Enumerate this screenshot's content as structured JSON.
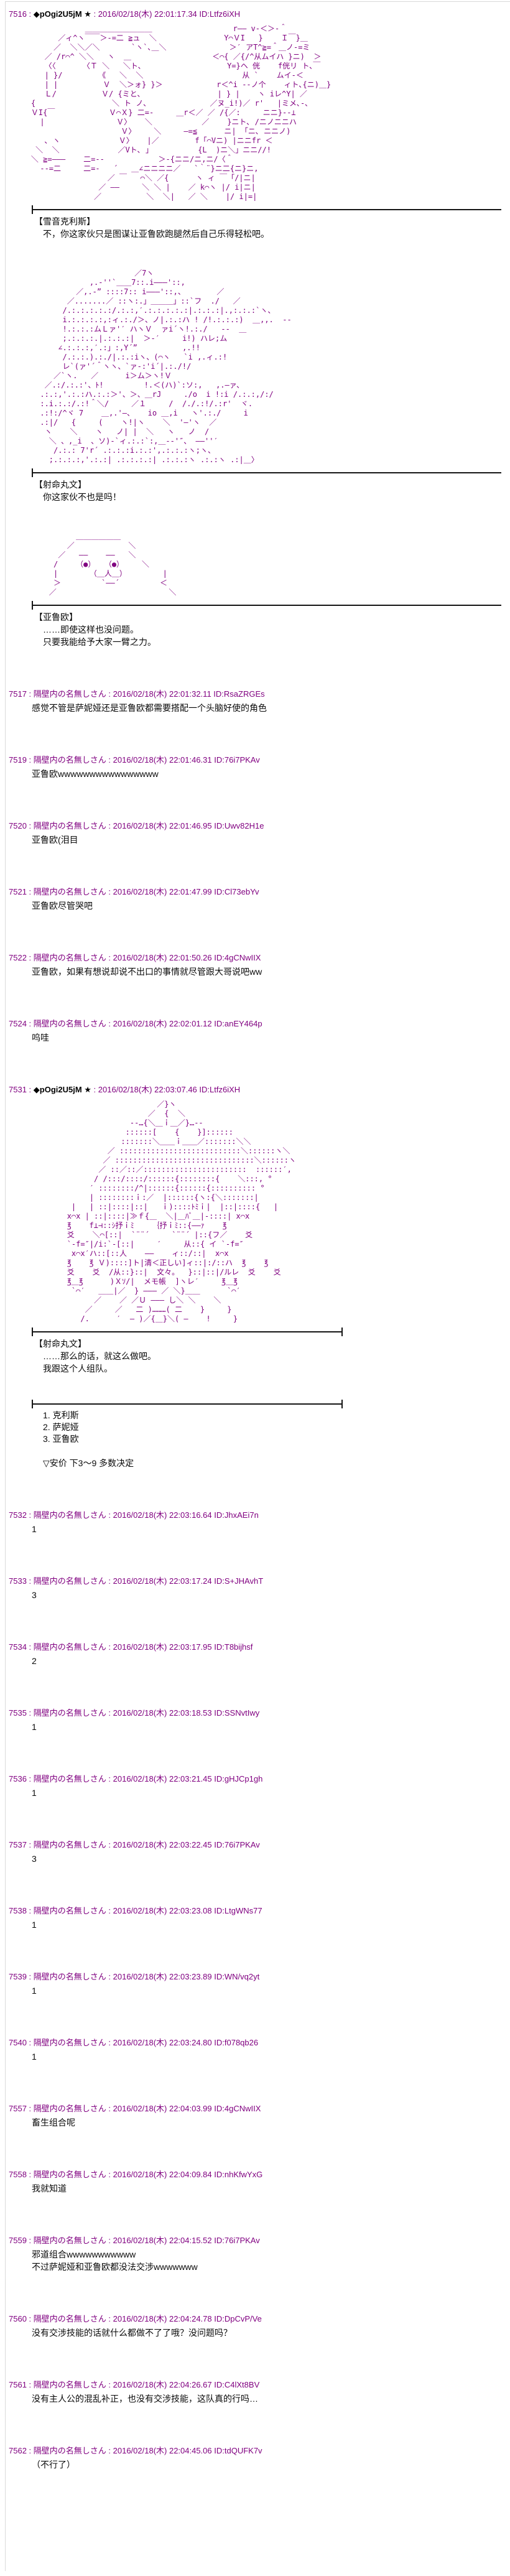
{
  "colors": {
    "header_accent": "#800080",
    "aa_art": "#800080",
    "body_text": "#0a0a0a",
    "divider": "#151515",
    "background": "#ffffff"
  },
  "separator": " : ",
  "posts": [
    {
      "number": "7516",
      "name": "◆pOgi2U5jM ★",
      "trip": true,
      "date": "2016/02/18(木) 22:01:17.34",
      "id": "ID:Ltfz6iXH",
      "blocks": [
        {
          "type": "aa",
          "lines": [
            "                ＿＿＿＿＿＿＿＿＿                  r―― v-＜＞-＾",
            "          ／ィ^ヽ￣￣＞-=二 ≧ュ  ＼               Y⌒ＶI   }    Ｉ￣}＿",
            "         ／  ＼＼／＼       `ヽ`､＿＼              ＞′ アT^≧=＾＿ノ-=ミ",
            "       ／ /r⌒^ ＼＼   ヽ  ＿                  ＜⌒{ ／{/^从ムイハ }ニ)  ＞",
            "       〈〈      〈Ｔ ＼   ＼ト､                   Y=}ヘ 侊    f侊リ ト､￣",
            "       | }/        《   ＼  ＼                      从 `    ムイ-＜",
            "       | |          Ｖ  ＼＞ォ} }＞            r＜^i --ノ个    ィト､{ニ)＿}",
            "       Ｌ/          Ｖ/ {ミと､                 | } |    ヽ iレ^Y| ／",
            "    {                 ＼ ト ノ､              ／ヌ_i!)／ r'   |ミメ､-､",
            "    ＶI{￣            Ｖ⌒Ｘ} 二=-     ＿r＜／ ／ /{／:     ニニ}--⊥",
            "      |                Ｖ〉   ＼           ／    }ニト､ /ニノニニハ",
            "                        Ｖ〉    ＼     —=≦      ニ| 「ニ､ ニニノ)",
            "       ､ ヽ             Ｖ〉   |／        f「⌒Vニ) |ニニfr ＜",
            "     ＼  ＼             ／Vト､ 」          {L  )ニ＼」ニニ//!",
            "    ＼ ≧=——―    二=--            ＞-{ニニ/ニ,ニ/〈＾",
            "      --=二     二=-   ´   ＿∠ニニニニ／   `｀¨}ニ二{ニ}ニ,",
            "                     ／ ￣   ⌒＼ ／{      ヽ ィ ￣「/|ニ|",
            "                   ／ ——     ＼ ＼ |    ／ k⌒ヽ |/ i|ニ|",
            "                  ／          ＼  ＼|   ／ ＼    |/ i|=|"
          ]
        },
        {
          "type": "divider",
          "ends": "left"
        },
        {
          "type": "dialog",
          "speaker": "【雪音克利斯】",
          "lines": [
            "不，你这家伙只是图谋让亚鲁欧跑腿然后自己乐得轻松吧。"
          ]
        },
        {
          "type": "aa",
          "lines": [
            "                           ／7ヽ",
            "                 ,.‐''`＿＿7::.i———'::,",
            "              ／,.‐” ::::7:: i———'::,、       ／",
            "            ／.......／ ::ヽ:.」＿＿＿」::`フ  ./   ／",
            "           /.:.:.:.:.:/.:.:,′.:.:.:.:.:|.:.:.:|.,:.:.:`ヽ、",
            "           i.:.:.:.:,:ィ.:./＞、ノ|.:.:ハ ! /!.:.:.:)  ＿,,.  --",
            "           !.:.:.:ムＬァ'′ ハヽＶ  ァi´ヽ!.:./   --  ＿",
            "           ;.:.:.:.|.:.:.:|  ＞-′     i!) ハレ;ム",
            "          ∠.:.:.:,′.:」:,Y´”          ,.!!",
            "           /.:.:.).:./|.:.:iヽ、(⌒ヽ   `i ,.ィ.:!",
            "           レ`(ァ'´＾ヽヽ、`ァ-:'i´|.:./!/",
            "         ／`ヽ.   ／      i＞ム＞ヽ!Ｖ",
            "       ／.:/.:.:'、ﾄ!         !.＜(ハ)`:ソ:,   ,.—ァ、",
            "      .:.:,'.:.:ハ.:.:＞'、＞、＿rJ     ./o  i !:i /.:.:,/:/",
            "      :.i.:.:/.:!＾＼/     ／１     /  /./.:!/.:r'  ヾ.",
            "      .:!:/^ヾ 7    ＿,.'—、   io ＿,i   ヽ'.:./     i",
            "      .:|/   {     (    ヽ!|ヽ    ＼  '—'ヽ  ／",
            "       ヽ    ＼    ヽ   ノ| |  ＼   ヽ   ノ  /",
            "        ＼ 、,_i  、ソ)-`ィ.:.:`:,＿--'″、 ——''′",
            "         /.:.: 7'r´ .:.:.:i.:.:',.:.:.:ヽ;ヽ、",
            "        ;.:.:.:,'.:.:| .:.:.:.:| .:.:.:ヽ .:.:ヽ .:|＿〉"
          ]
        },
        {
          "type": "divider",
          "ends": "left"
        },
        {
          "type": "dialog",
          "speaker": "【射命丸文】",
          "lines": [
            "你这家伙不也是吗！"
          ]
        },
        {
          "type": "aa",
          "lines": [
            "              ＿＿＿＿＿＿",
            "            ／            ＼",
            "          ／   ——    ——   ＼",
            "         /    （●）  （●）    ＼",
            "         |       （＿人＿）        |",
            "         ＞         `——´         ＜",
            "        ／                         ＼"
          ]
        },
        {
          "type": "divider",
          "ends": "left"
        },
        {
          "type": "dialog",
          "speaker": "【亚鲁欧】",
          "lines": [
            "……即使这样也没问题。",
            "只要我能给予大家一臂之力。"
          ]
        }
      ]
    },
    {
      "number": "7517",
      "name": "隔壁内の名無しさん",
      "trip": false,
      "date": "2016/02/18(木) 22:01:32.11",
      "id": "ID:RsaZRGEs",
      "blocks": [
        {
          "type": "text",
          "lines": [
            "感觉不管是萨妮娅还是亚鲁欧都需要搭配一个头脑好使的角色"
          ]
        }
      ]
    },
    {
      "number": "7519",
      "name": "隔壁内の名無しさん",
      "trip": false,
      "date": "2016/02/18(木) 22:01:46.31",
      "id": "ID:76i7PKAv",
      "blocks": [
        {
          "type": "text",
          "lines": [
            "亚鲁欧wwwwwwwwwwwwwwww"
          ]
        }
      ]
    },
    {
      "number": "7520",
      "name": "隔壁内の名無しさん",
      "trip": false,
      "date": "2016/02/18(木) 22:01:46.95",
      "id": "ID:Uwv82H1e",
      "blocks": [
        {
          "type": "text",
          "lines": [
            "亚鲁欧(泪目"
          ]
        }
      ]
    },
    {
      "number": "7521",
      "name": "隔壁内の名無しさん",
      "trip": false,
      "date": "2016/02/18(木) 22:01:47.99",
      "id": "ID:Cl73ebYv",
      "blocks": [
        {
          "type": "text",
          "lines": [
            "亚鲁欧尽管哭吧"
          ]
        }
      ]
    },
    {
      "number": "7522",
      "name": "隔壁内の名無しさん",
      "trip": false,
      "date": "2016/02/18(木) 22:01:50.26",
      "id": "ID:4gCNwIIX",
      "blocks": [
        {
          "type": "text",
          "lines": [
            "亚鲁欧，如果有想说却说不出口的事情就尽管跟大哥说吧ww"
          ]
        }
      ]
    },
    {
      "number": "7524",
      "name": "隔壁内の名無しさん",
      "trip": false,
      "date": "2016/02/18(木) 22:02:01.12",
      "id": "ID:anEY464p",
      "blocks": [
        {
          "type": "text",
          "lines": [
            "呜哇"
          ]
        }
      ]
    },
    {
      "number": "7531",
      "name": "◆pOgi2U5jM ★",
      "trip": true,
      "date": "2016/02/18(木) 22:03:07.46",
      "id": "ID:Ltfz6iXH",
      "blocks": [
        {
          "type": "aa",
          "lines": [
            "                                ／}ヽ",
            "                              ／  {  ＼",
            "                          --…{＼＿ｉ＿／}…--",
            "                         ::::::[    {    }]::::::",
            "                        :::::::＼＿＿ｉ＿＿／:::::::＼＼",
            "                     ／ :::::::::::::::::::::::::::＼::::::ヽ＼",
            "                    ／ :::::::::::::::::::::::::::::::＼::::::ヽ",
            "                   ／ ::／::／:::::::::::::::::::::::  ::::::′,",
            "                  / /:::/::::/::::::{::::::::{    ＼:::, °",
            "                 ′ ::::::::/^|::::::{::::::{:::::::::: °",
            "                 | ::::::::ｉ:／  |::::::{ヽ:{＼:::::::|",
            "             |   | ::|::::|::|   ｉ)::::ﾄﾐｉ|  |::|::::{   |",
            "            x⌒x | ::|::::|≫ｆ{＿  ＼|＿ﾊﾞ＿|-::::| x⌒x",
            "            ℥    f⊥⊣::ｼ抒ｉﾐ    ｛抒ｉﾐ::{――ｧ    ℥",
            "            爻    ＼⌒[::|  `¨¨´     `¨¨´ |::{フ／    爻",
            "            `-f=″|/i:`-[::|     ′     从::{ イ `-f=″",
            "             x⌒x′ハ::[::人    ——    ィ::/::|  x⌒x",
            "            ℥    ℥ Ｖ)::::]ト|清＜正しい]ィ::|:/::ハ  ℥    ℥",
            "            爻    爻  /从::}::|  文々。  }::|::|/ルレ  爻    爻",
            "            ℥＿℥      )Ｘｿ/|  メモ帳  ]ヽレ′     ℥＿℥",
            "             `⌒′   ＿＿|／  } ――― ／ ＼}＿＿      `⌒′",
            "                  ／    ／ ／Ｕ ――― し＼ ＼    ＼",
            "                ／     ／   二 )………( 二    }     }",
            "               /.      ′  ― )／{＿}＼( ―    !     }"
          ]
        },
        {
          "type": "divider",
          "ends": "both"
        },
        {
          "type": "dialog",
          "speaker": "【射命丸文】",
          "lines": [
            "……那么的话，就这么做吧。",
            "我跟这个人组队。"
          ]
        },
        {
          "type": "divider",
          "ends": "both"
        },
        {
          "type": "options",
          "lines": [
            "1. 克利斯",
            "2. 萨妮娅",
            "3. 亚鲁欧"
          ]
        },
        {
          "type": "anchor",
          "text": "▽安价  下3～9  多数决定"
        }
      ]
    },
    {
      "number": "7532",
      "name": "隔壁内の名無しさん",
      "trip": false,
      "date": "2016/02/18(木) 22:03:16.64",
      "id": "ID:JhxAEi7n",
      "blocks": [
        {
          "type": "text",
          "lines": [
            "1"
          ]
        }
      ]
    },
    {
      "number": "7533",
      "name": "隔壁内の名無しさん",
      "trip": false,
      "date": "2016/02/18(木) 22:03:17.24",
      "id": "ID:S+JHAvhT",
      "blocks": [
        {
          "type": "text",
          "lines": [
            "3"
          ]
        }
      ]
    },
    {
      "number": "7534",
      "name": "隔壁内の名無しさん",
      "trip": false,
      "date": "2016/02/18(木) 22:03:17.95",
      "id": "ID:T8bijhsf",
      "blocks": [
        {
          "type": "text",
          "lines": [
            "2"
          ]
        }
      ]
    },
    {
      "number": "7535",
      "name": "隔壁内の名無しさん",
      "trip": false,
      "date": "2016/02/18(木) 22:03:18.53",
      "id": "ID:SSNvtIwy",
      "blocks": [
        {
          "type": "text",
          "lines": [
            "1"
          ]
        }
      ]
    },
    {
      "number": "7536",
      "name": "隔壁内の名無しさん",
      "trip": false,
      "date": "2016/02/18(木) 22:03:21.45",
      "id": "ID:gHJCp1gh",
      "blocks": [
        {
          "type": "text",
          "lines": [
            "1"
          ]
        }
      ]
    },
    {
      "number": "7537",
      "name": "隔壁内の名無しさん",
      "trip": false,
      "date": "2016/02/18(木) 22:03:22.45",
      "id": "ID:76i7PKAv",
      "blocks": [
        {
          "type": "text",
          "lines": [
            "3"
          ]
        }
      ]
    },
    {
      "number": "7538",
      "name": "隔壁内の名無しさん",
      "trip": false,
      "date": "2016/02/18(木) 22:03:23.08",
      "id": "ID:LtgWNs77",
      "blocks": [
        {
          "type": "text",
          "lines": [
            "1"
          ]
        }
      ]
    },
    {
      "number": "7539",
      "name": "隔壁内の名無しさん",
      "trip": false,
      "date": "2016/02/18(木) 22:03:23.89",
      "id": "ID:WN/vq2yt",
      "blocks": [
        {
          "type": "text",
          "lines": [
            "1"
          ]
        }
      ]
    },
    {
      "number": "7540",
      "name": "隔壁内の名無しさん",
      "trip": false,
      "date": "2016/02/18(木) 22:03:24.80",
      "id": "ID:f078qb26",
      "blocks": [
        {
          "type": "text",
          "lines": [
            "1"
          ]
        }
      ]
    },
    {
      "number": "7557",
      "name": "隔壁内の名無しさん",
      "trip": false,
      "date": "2016/02/18(木) 22:04:03.99",
      "id": "ID:4gCNwIIX",
      "blocks": [
        {
          "type": "text",
          "lines": [
            "畜生组合呢"
          ]
        }
      ]
    },
    {
      "number": "7558",
      "name": "隔壁内の名無しさん",
      "trip": false,
      "date": "2016/02/18(木) 22:04:09.84",
      "id": "ID:nhKfwYxG",
      "blocks": [
        {
          "type": "text",
          "lines": [
            "我就知道"
          ]
        }
      ]
    },
    {
      "number": "7559",
      "name": "隔壁内の名無しさん",
      "trip": false,
      "date": "2016/02/18(木) 22:04:15.52",
      "id": "ID:76i7PKAv",
      "blocks": [
        {
          "type": "text",
          "lines": [
            "邪道组合wwwwwwwwwww",
            "不过萨妮娅和亚鲁欧都没法交涉wwwwwww"
          ]
        }
      ]
    },
    {
      "number": "7560",
      "name": "隔壁内の名無しさん",
      "trip": false,
      "date": "2016/02/18(木) 22:04:24.78",
      "id": "ID:DpCvP/Ve",
      "blocks": [
        {
          "type": "text",
          "lines": [
            "没有交涉技能的话就什么都做不了了哦？没问题吗？"
          ]
        }
      ]
    },
    {
      "number": "7561",
      "name": "隔壁内の名無しさん",
      "trip": false,
      "date": "2016/02/18(木) 22:04:26.67",
      "id": "ID:C4lXt8BV",
      "blocks": [
        {
          "type": "text",
          "lines": [
            "没有主人公的混乱补正，也没有交涉技能，这队真的行吗…"
          ]
        }
      ]
    },
    {
      "number": "7562",
      "name": "隔壁内の名無しさん",
      "trip": false,
      "date": "2016/02/18(木) 22:04:45.06",
      "id": "ID:tdQUFK7v",
      "blocks": [
        {
          "type": "text",
          "lines": [
            "（不行了）"
          ]
        }
      ]
    }
  ]
}
